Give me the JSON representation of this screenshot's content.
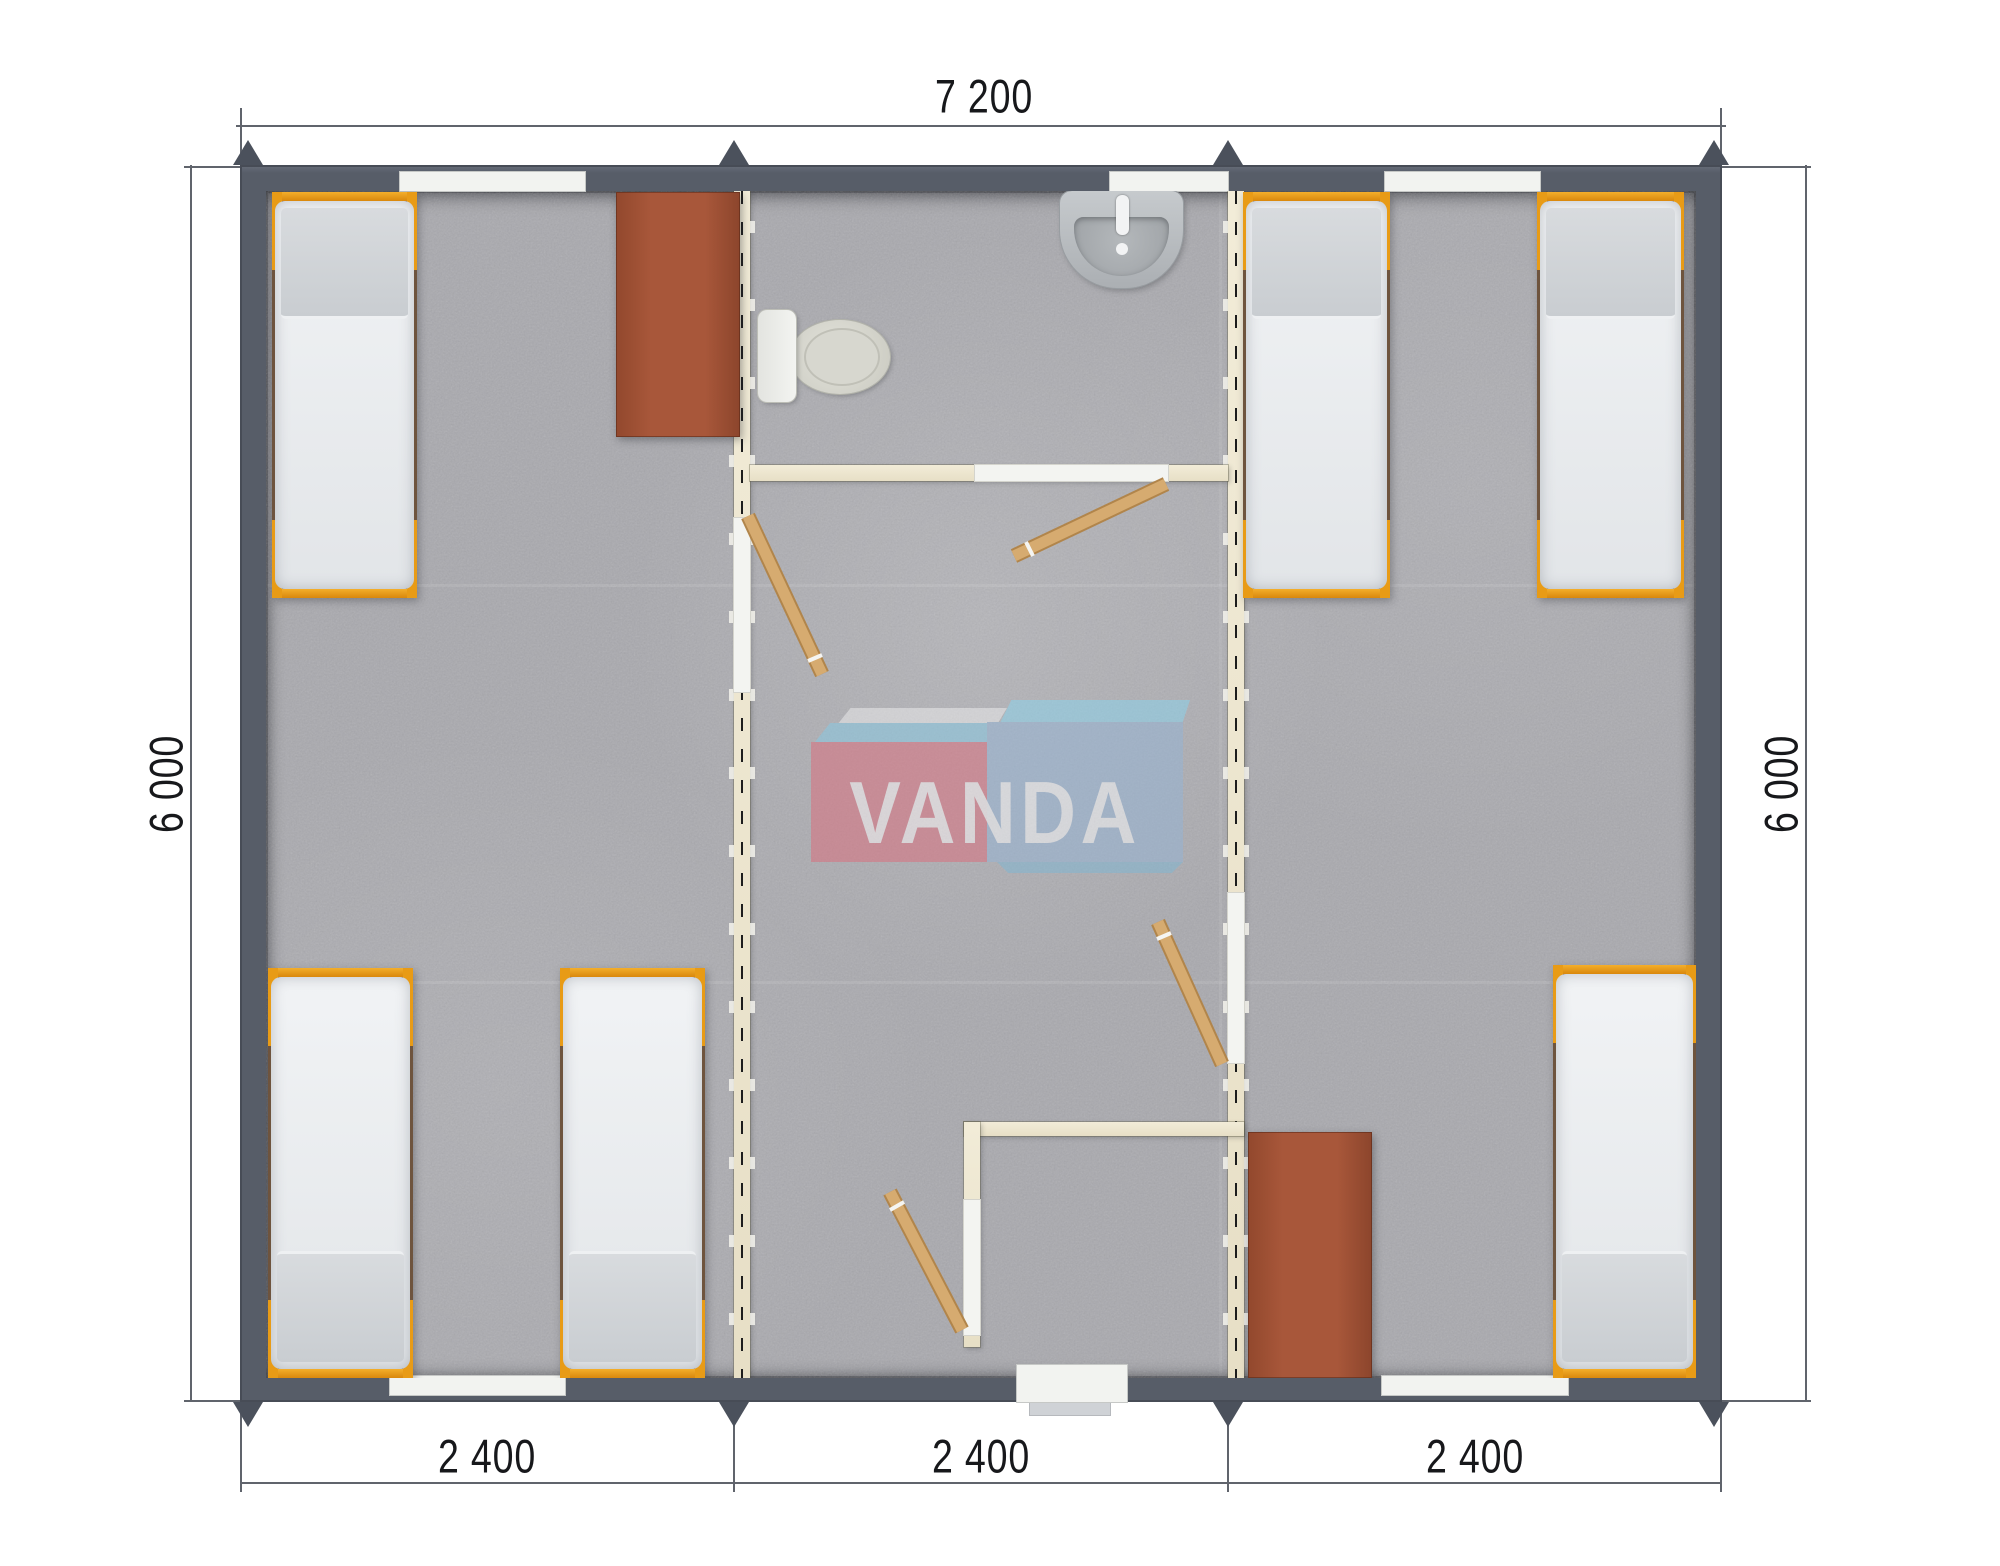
{
  "dimensions": {
    "top_width_mm": "7 200",
    "left_height_mm": "6 000",
    "right_height_mm": "6 000",
    "bottom_segments_mm": [
      "2 400",
      "2 400",
      "2 400"
    ]
  },
  "watermark": {
    "text": "VANDA"
  },
  "colors": {
    "exterior_wall": "#575d68",
    "floor": "#a9a9ae",
    "partition_wall": "#ece5d0",
    "bed_frame_accent": "#e89b16",
    "furniture_brown": "#a8573a",
    "door_wood": "#d6ab70",
    "logo_red": "#dc6d7c",
    "logo_blue": "#95b4d6",
    "logo_light_blue": "#8ad4ee"
  },
  "plan_objects": {
    "beds": 6,
    "toilet": 1,
    "sink": 1,
    "wardrobes": 2,
    "open_doors": 4,
    "windows": 5,
    "entrance_doorways": 1
  }
}
